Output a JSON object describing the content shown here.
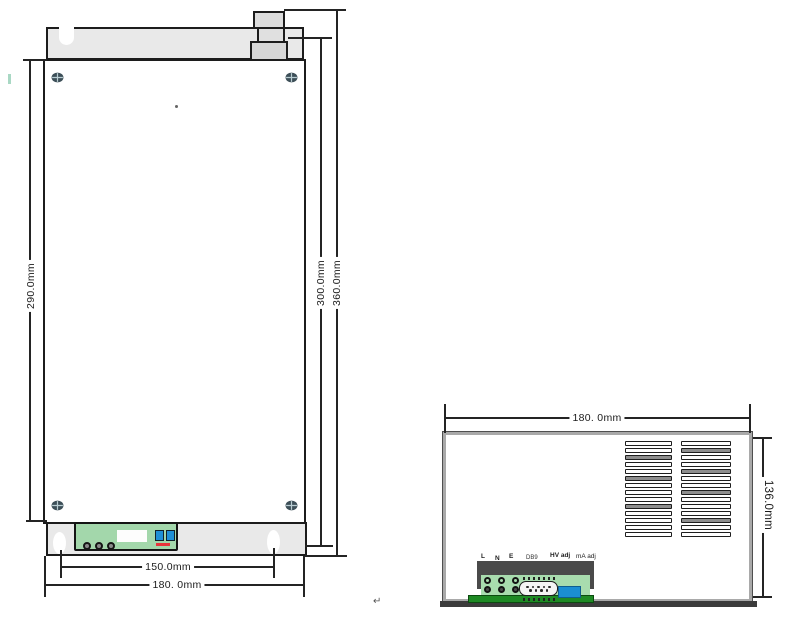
{
  "front_view": {
    "dim_body_height": "290.0mm",
    "dim_flange_height": "300.0mm",
    "dim_total_height": "360.0mm",
    "dim_hole_spacing": "150.0mm",
    "dim_width": "180. 0mm"
  },
  "side_view": {
    "dim_width": "180. 0mm",
    "dim_height": "136.0mm",
    "panel_labels": [
      "L",
      "N",
      "E",
      "DB9",
      "HV adj",
      "mA adj"
    ],
    "vents": {
      "columns": 2,
      "rows_per_column": 14,
      "gray_rows_left": [
        3,
        6,
        10
      ],
      "gray_rows_right": [
        2,
        5,
        8,
        12
      ]
    }
  },
  "icons": {
    "screw": "phillips-screw-icon",
    "return_mark_glyph": "carriage-return-icon"
  },
  "artifacts": {
    "return_mark": "↵"
  },
  "colors": {
    "flange_gray": "#e9e9e9",
    "terminal_green": "#a3d7ab",
    "pcb_green": "#1e8a24",
    "connector_blue": "#1f8fd6",
    "indicator_red": "#e8333a",
    "panel_dark": "#4a4a4a",
    "line": "#242424"
  }
}
